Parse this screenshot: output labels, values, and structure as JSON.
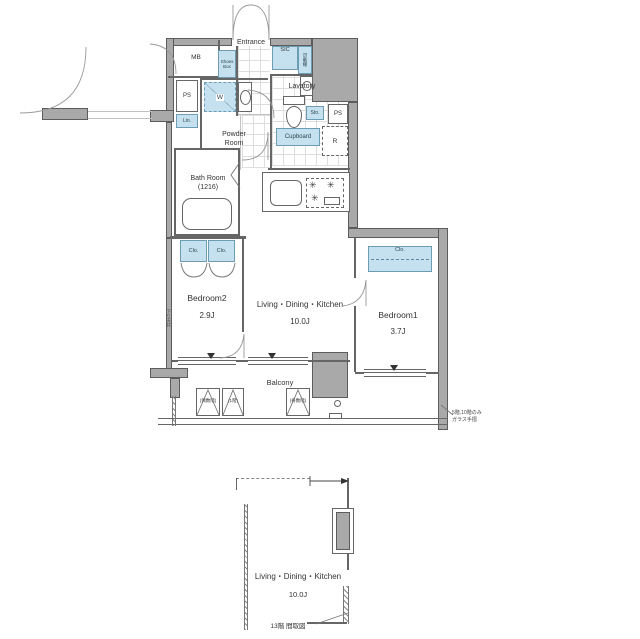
{
  "colors": {
    "wall-fill": "#a9a9a9",
    "wall-edge": "#5c5c5c",
    "fixture-fill": "#c5e1ef",
    "fixture-edge": "#6d9cb5",
    "line": "#666666",
    "text": "#333333"
  },
  "floor_plan": {
    "rooms": [
      {
        "name": "Bedroom2",
        "size": "2.9J"
      },
      {
        "name": "Living・Dining・Kitchen",
        "size": "10.0J"
      },
      {
        "name": "Bedroom1",
        "size": "3.7J"
      }
    ],
    "areas": {
      "entrance": "Entrance",
      "balcony": "Balcony",
      "lavatory": "Lavatory",
      "powder_room": [
        "Powder",
        "Room"
      ],
      "bath_room": [
        "Bath Room",
        "(1216)"
      ]
    },
    "fixtures": {
      "mb": "MB",
      "shoes_box": [
        "Shoes",
        "Box"
      ],
      "sic": "SIC",
      "movable_shelf": "可動棚",
      "storage": "Sto.",
      "ps": "PS",
      "linen": "Lin.",
      "washer": "W",
      "cupboard": "Cupboard",
      "refrigerator": "R",
      "closet": "Clo."
    },
    "balcony_items": {
      "ac_even": "(偶数階)",
      "ac_first": "(1階)",
      "ac_odd": "(奇数階)"
    },
    "notes": {
      "glass_line1": "5階,10階のみ",
      "glass_line2": "ガラス手摺",
      "wall_vertical": "下り天井"
    }
  },
  "sub_plan": {
    "room": {
      "name": "Living・Dining・Kitchen",
      "size": "10.0J"
    },
    "caption": "13階 間取図"
  }
}
